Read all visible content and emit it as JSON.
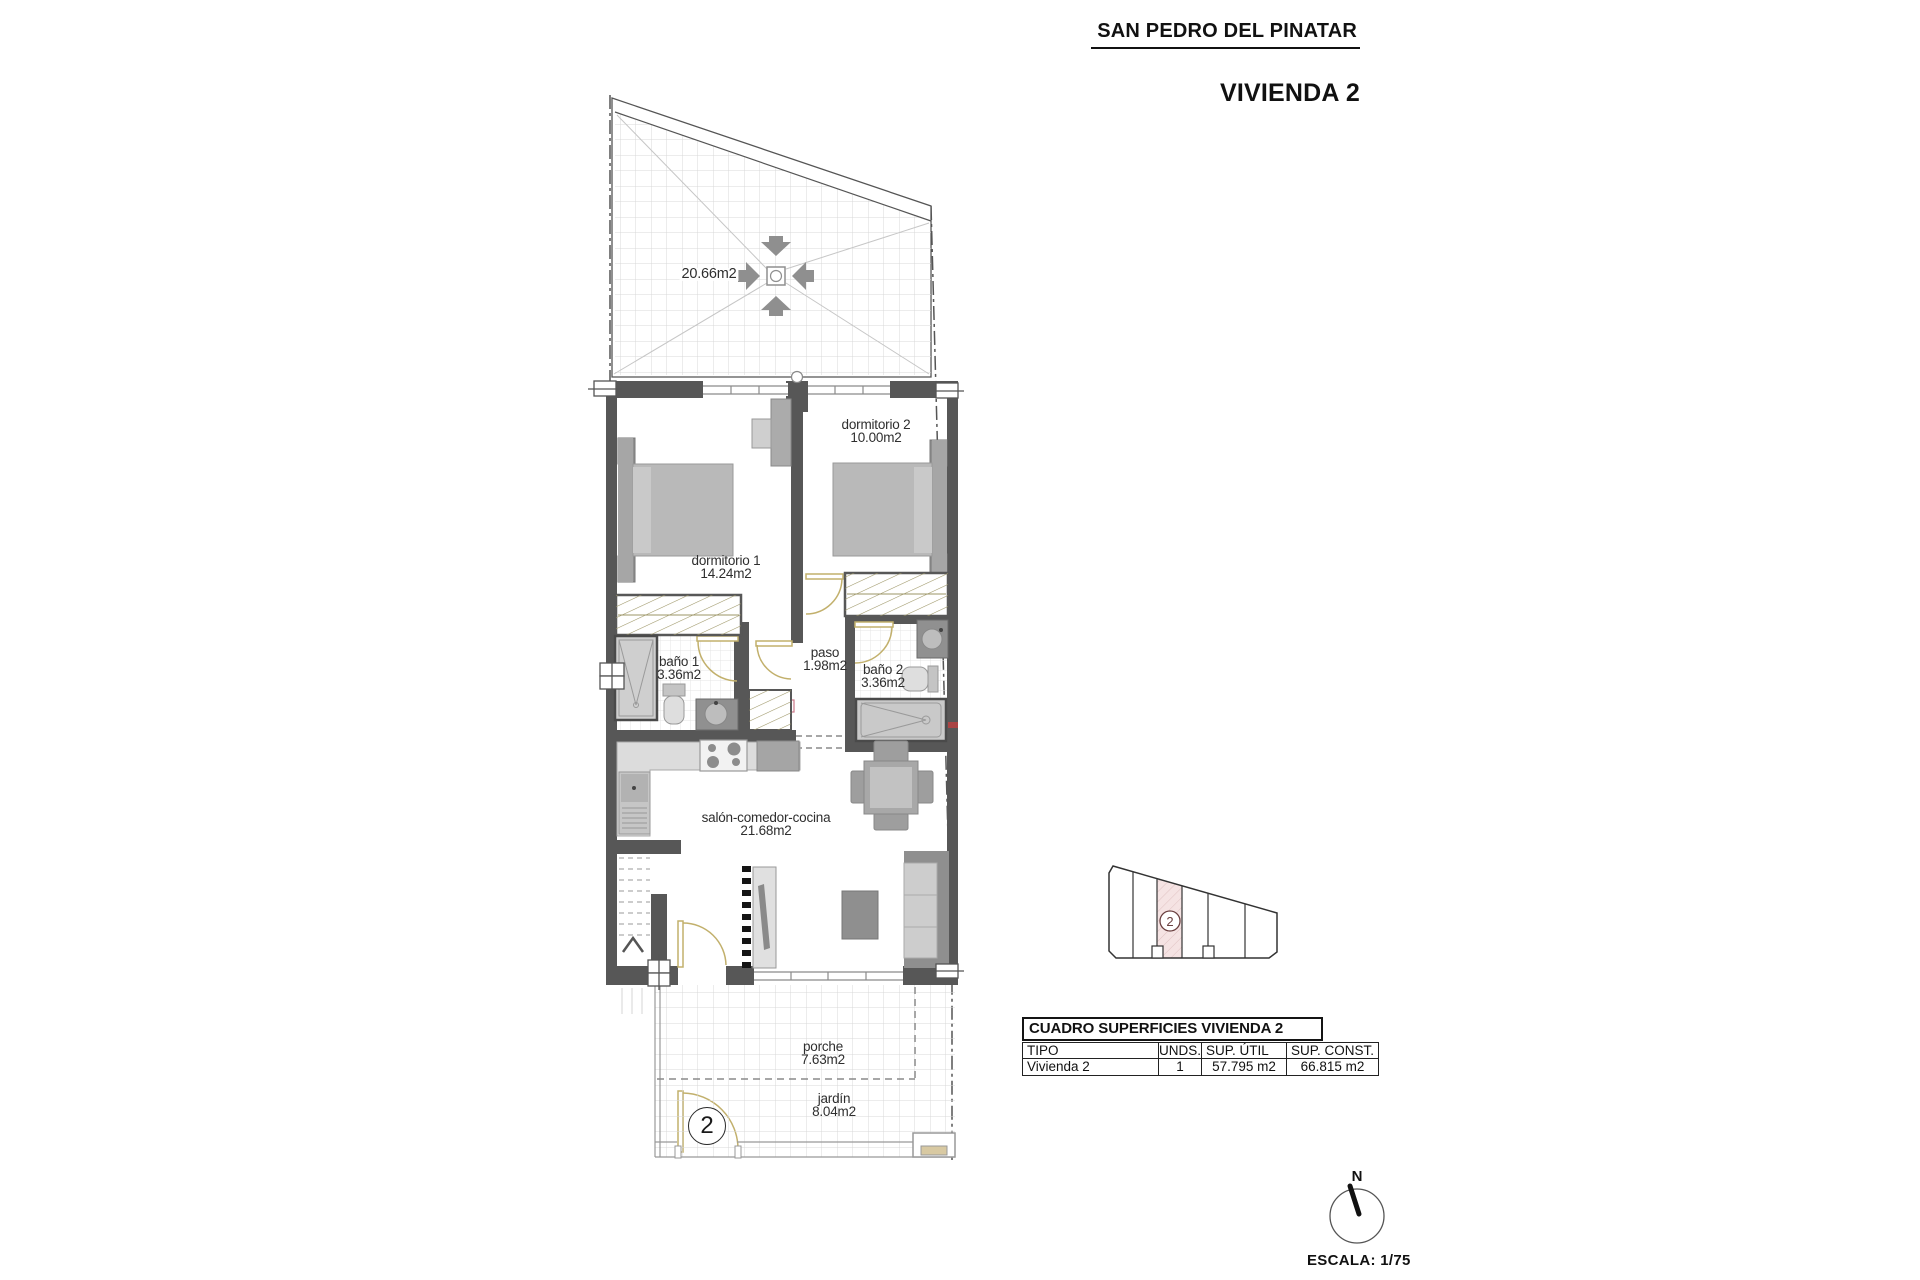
{
  "header": {
    "location_title": "SAN PEDRO DEL PINATAR",
    "unit_title": "VIVIENDA 2"
  },
  "floorplan": {
    "roof_terrace": {
      "area": "20.66m2"
    },
    "rooms": {
      "dormitorio1": {
        "name": "dormitorio 1",
        "area": "14.24m2"
      },
      "dormitorio2": {
        "name": "dormitorio 2",
        "area": "10.00m2"
      },
      "bano1": {
        "name": "baño 1",
        "area": "3.36m2"
      },
      "paso": {
        "name": "paso",
        "area": "1.98m2"
      },
      "bano2": {
        "name": "baño 2",
        "area": "3.36m2"
      },
      "salon": {
        "name": "salón-comedor-cocina",
        "area": "21.68m2"
      },
      "porche": {
        "name": "porche",
        "area": "7.63m2"
      },
      "jardin": {
        "name": "jardín",
        "area": "8.04m2"
      }
    },
    "entrance_badge": "2"
  },
  "site_plan": {
    "highlighted_unit": "2"
  },
  "surfaces_table": {
    "title": "CUADRO SUPERFICIES VIVIENDA 2",
    "columns": [
      "TIPO",
      "UNDS.",
      "SUP. ÚTIL",
      "SUP. CONST."
    ],
    "row": [
      "Vivienda 2",
      "1",
      "57.795 m2",
      "66.815 m2"
    ]
  },
  "compass": {
    "north": "N"
  },
  "scale": {
    "label": "ESCALA: 1/75"
  },
  "colors": {
    "wall": "#575757",
    "furniture_gray": "#b9b9b9",
    "hatch_olive": "#9b9464",
    "door_tan": "#c2b06c",
    "unit_highlight": "#f5e3e3",
    "unit_number": "#6b4040"
  }
}
